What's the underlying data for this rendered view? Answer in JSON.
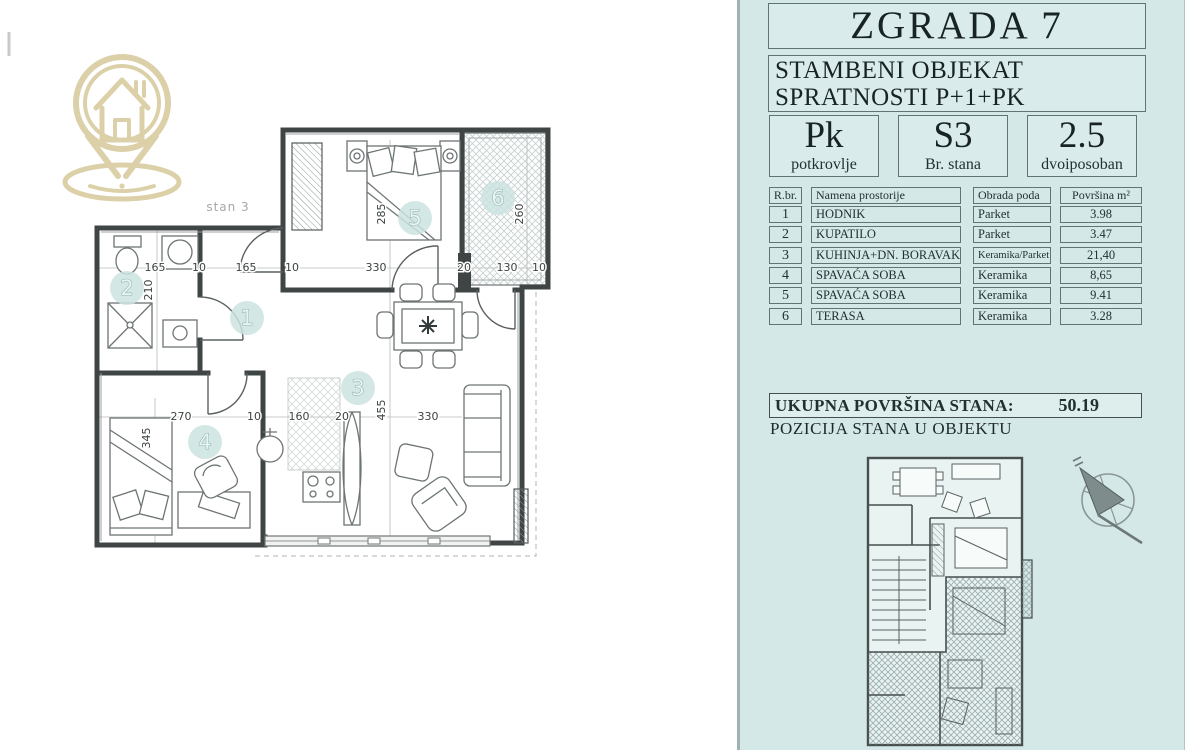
{
  "panel": {
    "title": "ZGRADA 7",
    "subtitle_line1": "STAMBENI OBJEKAT",
    "subtitle_line2": "SPRATNOSTI P+1+PK",
    "stats": [
      {
        "value": "Pk",
        "label": "potkrovlje"
      },
      {
        "value": "S3",
        "label": "Br. stana"
      },
      {
        "value": "2.5",
        "label": "dvoiposoban"
      }
    ],
    "table": {
      "headers": [
        "R.br.",
        "Namena prostorije",
        "Obrada poda",
        "Površina  m²"
      ],
      "rows": [
        {
          "num": "1",
          "name": "HODNIK",
          "floor": "Parket",
          "area": "3.98"
        },
        {
          "num": "2",
          "name": "KUPATILO",
          "floor": "Parket",
          "area": "3.47"
        },
        {
          "num": "3",
          "name": "KUHINJA+DN. BORAVAK",
          "floor": "Keramika/Parket",
          "area": "21,40"
        },
        {
          "num": "4",
          "name": "SPAVAĆA SOBA",
          "floor": "Keramika",
          "area": "8,65"
        },
        {
          "num": "5",
          "name": "SPAVAĆA SOBA",
          "floor": "Keramika",
          "area": "9.41"
        },
        {
          "num": "6",
          "name": "TERASA",
          "floor": "Keramika",
          "area": "3.28"
        }
      ]
    },
    "total_label": "UKUPNA POVRŠINA STANA:",
    "total_value": "50.19",
    "position_label": "POZICIJA STANA  U OBJEKTU"
  },
  "plan": {
    "unit_label": "stan 3",
    "room_markers": [
      {
        "num": "1",
        "x": 247,
        "y": 318
      },
      {
        "num": "2",
        "x": 127,
        "y": 288
      },
      {
        "num": "3",
        "x": 358,
        "y": 388
      },
      {
        "num": "4",
        "x": 205,
        "y": 442
      },
      {
        "num": "5",
        "x": 415,
        "y": 218
      },
      {
        "num": "6",
        "x": 498,
        "y": 198
      }
    ],
    "dimensions": [
      {
        "text": "165",
        "x": 155,
        "y": 271,
        "rot": 0
      },
      {
        "text": "10",
        "x": 199,
        "y": 271,
        "rot": 0
      },
      {
        "text": "165",
        "x": 246,
        "y": 271,
        "rot": 0
      },
      {
        "text": "10",
        "x": 292,
        "y": 271,
        "rot": 0
      },
      {
        "text": "330",
        "x": 376,
        "y": 271,
        "rot": 0
      },
      {
        "text": "20",
        "x": 464,
        "y": 271,
        "rot": 0
      },
      {
        "text": "130",
        "x": 507,
        "y": 271,
        "rot": 0
      },
      {
        "text": "10",
        "x": 539,
        "y": 271,
        "rot": 0
      },
      {
        "text": "270",
        "x": 181,
        "y": 420,
        "rot": 0
      },
      {
        "text": "10",
        "x": 254,
        "y": 420,
        "rot": 0
      },
      {
        "text": "160",
        "x": 299,
        "y": 420,
        "rot": 0
      },
      {
        "text": "20",
        "x": 342,
        "y": 420,
        "rot": 0
      },
      {
        "text": "330",
        "x": 428,
        "y": 420,
        "rot": 0
      },
      {
        "text": "210",
        "x": 152,
        "y": 290,
        "rot": -90
      },
      {
        "text": "285",
        "x": 385,
        "y": 214,
        "rot": -90
      },
      {
        "text": "260",
        "x": 523,
        "y": 214,
        "rot": -90
      },
      {
        "text": "345",
        "x": 150,
        "y": 438,
        "rot": -90
      },
      {
        "text": "455",
        "x": 385,
        "y": 410,
        "rot": -90
      }
    ]
  },
  "colors": {
    "panel_bg": "#d3e8e7",
    "wall": "#3f4444",
    "furniture": "#6d7474",
    "dim_text": "#3c4242",
    "marker_fill": "#cbe3e0",
    "marker_stroke": "#8fb5b2",
    "logo": "#dcd0a8",
    "compass": "#7e8c8b"
  }
}
